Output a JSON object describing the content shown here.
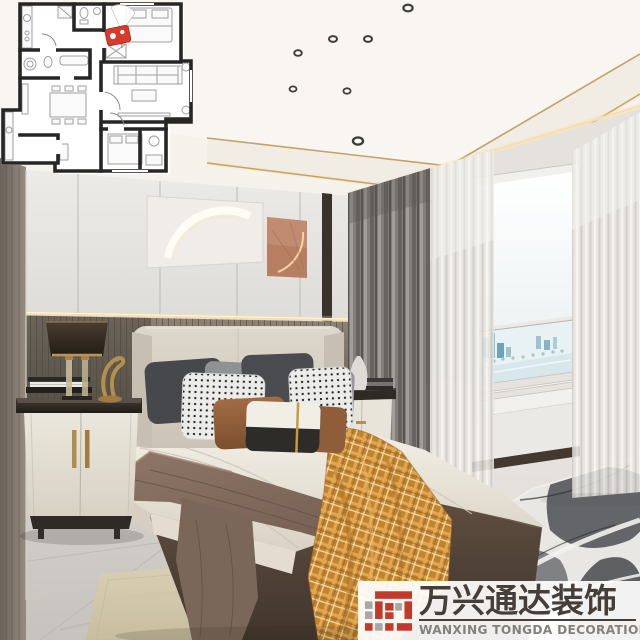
{
  "watermark": {
    "brand_cn": "万兴通达装饰",
    "brand_en": "WANXING TONGDA DECORATION"
  },
  "palette": {
    "brand_red": "#c23a2c",
    "brand_gray": "#a8a7a5",
    "wm_text_dark": "#453e39",
    "wm_text_gray": "#84817d",
    "wm_bg": "rgba(255,255,255,0.92)",
    "pin_red": "#d8392b",
    "plan_wall": "#262626",
    "gold_trim": "#c3a268",
    "led_warm": "#f6dfae",
    "orange_base": "#c2832f"
  }
}
